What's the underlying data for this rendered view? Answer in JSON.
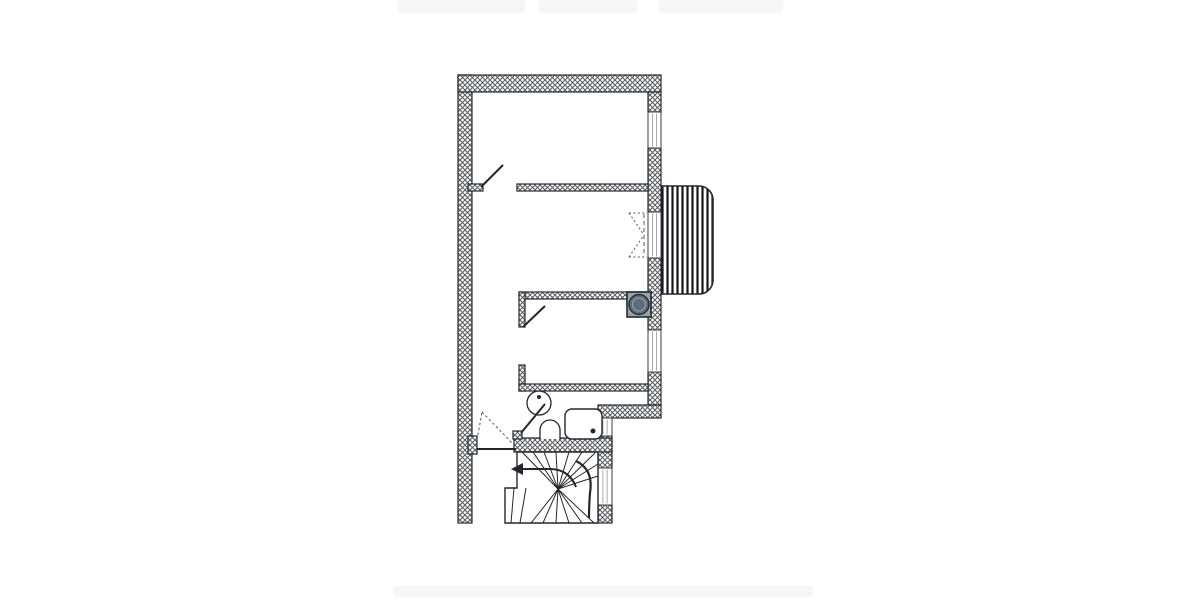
{
  "meta": {
    "description": "architectural floor plan, upper storey with winder stair",
    "background": "#ffffff"
  },
  "palette": {
    "line": "#23272b",
    "hatch": "#565b61",
    "window_inner": "#9aa0a6",
    "window_frame": "#3a3f44",
    "door_dash": "#555a60",
    "stripe": "#14171a",
    "boiler_fill": "#97a2ab",
    "boiler_circle": "#5f6b76",
    "boiler_highlight": "#939ea8",
    "artifact": "#f6f6f6"
  },
  "artifacts": {
    "top_bars": [
      {
        "name": "cropped-ui-remnant",
        "x": 397,
        "y": 0,
        "w": 128,
        "h": 13
      },
      {
        "name": "cropped-ui-remnant",
        "x": 538,
        "y": 0,
        "w": 100,
        "h": 13
      },
      {
        "name": "cropped-ui-remnant",
        "x": 658,
        "y": 0,
        "w": 125,
        "h": 13
      }
    ],
    "bottom_bar": {
      "name": "cropped-ui-remnant",
      "x": 393,
      "y": 586,
      "w": 420,
      "h": 11
    }
  },
  "plan": {
    "exterior_walls": [
      {
        "name": "wall-left",
        "x": 458,
        "y": 75,
        "w": 14,
        "h": 448
      },
      {
        "name": "wall-top",
        "x": 458,
        "y": 75,
        "w": 203,
        "h": 17
      },
      {
        "name": "wall-right-seg1",
        "x": 648,
        "y": 92,
        "w": 13,
        "h": 20
      },
      {
        "name": "wall-right-seg2",
        "x": 648,
        "y": 148,
        "w": 13,
        "h": 64
      },
      {
        "name": "wall-right-seg3",
        "x": 648,
        "y": 258,
        "w": 13,
        "h": 72
      },
      {
        "name": "wall-right-seg4",
        "x": 648,
        "y": 372,
        "w": 13,
        "h": 33
      },
      {
        "name": "wall-jog-horizontal",
        "x": 598,
        "y": 405,
        "w": 63,
        "h": 13
      },
      {
        "name": "wall-lowerright-seg1",
        "x": 598,
        "y": 436,
        "w": 14,
        "h": 32
      },
      {
        "name": "wall-lowerright-seg2",
        "x": 598,
        "y": 505,
        "w": 14,
        "h": 18
      }
    ],
    "interior_walls": [
      {
        "name": "wall-room1-stub",
        "x": 468,
        "y": 184,
        "w": 15,
        "h": 7
      },
      {
        "name": "wall-room1-partition",
        "x": 517,
        "y": 184,
        "w": 131,
        "h": 7
      },
      {
        "name": "wall-room2-partition",
        "x": 519,
        "y": 292,
        "w": 129,
        "h": 7
      },
      {
        "name": "wall-room2-leg-upper",
        "x": 519,
        "y": 292,
        "w": 6,
        "h": 35
      },
      {
        "name": "wall-room2-leg-lower",
        "x": 519,
        "y": 365,
        "w": 6,
        "h": 26
      },
      {
        "name": "wall-bathroom-top",
        "x": 519,
        "y": 384,
        "w": 129,
        "h": 7
      },
      {
        "name": "wall-stair-top",
        "x": 514,
        "y": 438,
        "w": 98,
        "h": 14
      },
      {
        "name": "entry-door-jamb",
        "x": 468,
        "y": 436,
        "w": 9,
        "h": 18
      },
      {
        "name": "bath-door-stub",
        "x": 513,
        "y": 431,
        "w": 9,
        "h": 8
      }
    ],
    "windows": [
      {
        "name": "window-right-upper",
        "x": 648,
        "y": 112,
        "w": 13,
        "h": 36
      },
      {
        "name": "balcony-door-panel",
        "x": 648,
        "y": 212,
        "w": 13,
        "h": 46
      },
      {
        "name": "window-right-middle",
        "x": 648,
        "y": 330,
        "w": 13,
        "h": 42
      },
      {
        "name": "window-lower-small",
        "x": 598,
        "y": 418,
        "w": 14,
        "h": 18
      },
      {
        "name": "window-stairwell",
        "x": 598,
        "y": 468,
        "w": 14,
        "h": 37
      }
    ],
    "door_leaves": [
      {
        "name": "door-leaf-room1",
        "x1": 481,
        "y1": 187,
        "x2": 503,
        "y2": 165
      },
      {
        "name": "door-leaf-room3",
        "x1": 523,
        "y1": 327,
        "x2": 545,
        "y2": 306
      },
      {
        "name": "door-leaf-bathroom",
        "x1": 521,
        "y1": 433,
        "x2": 545,
        "y2": 404
      },
      {
        "name": "door-leaf-entry",
        "x1": 477,
        "y1": 449,
        "x2": 516,
        "y2": 449
      }
    ],
    "dotted_segments": [
      {
        "name": "entry-door-swing",
        "x1": 477,
        "y1": 440,
        "x2": 482,
        "y2": 412,
        "dash": "2.5 2.5"
      },
      {
        "name": "entry-door-swing",
        "x1": 482,
        "y1": 412,
        "x2": 515,
        "y2": 446,
        "dash": "2.5 2.5"
      },
      {
        "name": "balcony-door-swing",
        "x1": 629,
        "y1": 213,
        "x2": 647,
        "y2": 213,
        "dash": "2 2.4"
      },
      {
        "name": "balcony-door-swing",
        "x1": 629,
        "y1": 257,
        "x2": 647,
        "y2": 257,
        "dash": "2 2.4"
      },
      {
        "name": "balcony-door-swing",
        "x1": 629,
        "y1": 213,
        "x2": 644,
        "y2": 235,
        "dash": "2 2.4"
      },
      {
        "name": "balcony-door-swing",
        "x1": 629,
        "y1": 257,
        "x2": 644,
        "y2": 235,
        "dash": "2 2.4"
      },
      {
        "name": "balcony-door-centerline",
        "x1": 644,
        "y1": 214,
        "x2": 644,
        "y2": 256,
        "dash": "4 3"
      }
    ],
    "stairs": {
      "outline": "M 517,452 H 598 V 523 H 505 V 488 H 517 Z",
      "treads": [
        {
          "x1": 558,
          "y1": 489,
          "x2": 522,
          "y2": 452
        },
        {
          "x1": 558,
          "y1": 489,
          "x2": 533,
          "y2": 452
        },
        {
          "x1": 558,
          "y1": 489,
          "x2": 544,
          "y2": 452
        },
        {
          "x1": 558,
          "y1": 489,
          "x2": 556,
          "y2": 452
        },
        {
          "x1": 558,
          "y1": 489,
          "x2": 569,
          "y2": 452
        },
        {
          "x1": 558,
          "y1": 489,
          "x2": 582,
          "y2": 452
        },
        {
          "x1": 558,
          "y1": 489,
          "x2": 595,
          "y2": 453
        },
        {
          "x1": 558,
          "y1": 489,
          "x2": 598,
          "y2": 464
        },
        {
          "x1": 558,
          "y1": 489,
          "x2": 598,
          "y2": 476
        },
        {
          "x1": 514,
          "y1": 488,
          "x2": 511,
          "y2": 523
        },
        {
          "x1": 526,
          "y1": 488,
          "x2": 520,
          "y2": 523
        },
        {
          "x1": 558,
          "y1": 489,
          "x2": 531,
          "y2": 523
        },
        {
          "x1": 558,
          "y1": 489,
          "x2": 543,
          "y2": 523
        },
        {
          "x1": 558,
          "y1": 489,
          "x2": 556,
          "y2": 523
        },
        {
          "x1": 558,
          "y1": 489,
          "x2": 569,
          "y2": 523
        },
        {
          "x1": 558,
          "y1": 489,
          "x2": 582,
          "y2": 523
        },
        {
          "x1": 558,
          "y1": 489,
          "x2": 594,
          "y2": 523
        }
      ],
      "railing": "M 576,461 C 590,468 592,480 590,493 C 589,505 589,512 589,518",
      "arrow_shaft": "M 519,469 H 550 C 563,469 572,476 576,487",
      "arrow_head": "511,469 523,463 523,475"
    },
    "deck": {
      "name": "balcony-decking",
      "x": 659,
      "y": 186,
      "w": 54,
      "h": 108,
      "r": 14
    },
    "boiler": {
      "name": "boiler-unit",
      "x": 627,
      "y": 292,
      "w": 24,
      "h": 25,
      "cx": 639,
      "cy": 304.5,
      "r": 10,
      "r_inner": 6.5
    },
    "fixtures": {
      "sink": {
        "name": "washbasin",
        "cx": 539,
        "cy": 403,
        "r": 12,
        "dot_cx": 539,
        "dot_cy": 397,
        "dot_r": 2
      },
      "wc": {
        "name": "toilet",
        "path": "M 540,439 V 430 A 10,10 0 0 1 560,430 V 439"
      },
      "shower": {
        "name": "shower-tray",
        "x": 565,
        "y": 409,
        "w": 37,
        "h": 30,
        "rx": 7,
        "dot_cx": 593,
        "dot_cy": 431,
        "dot_r": 2.5
      }
    }
  }
}
